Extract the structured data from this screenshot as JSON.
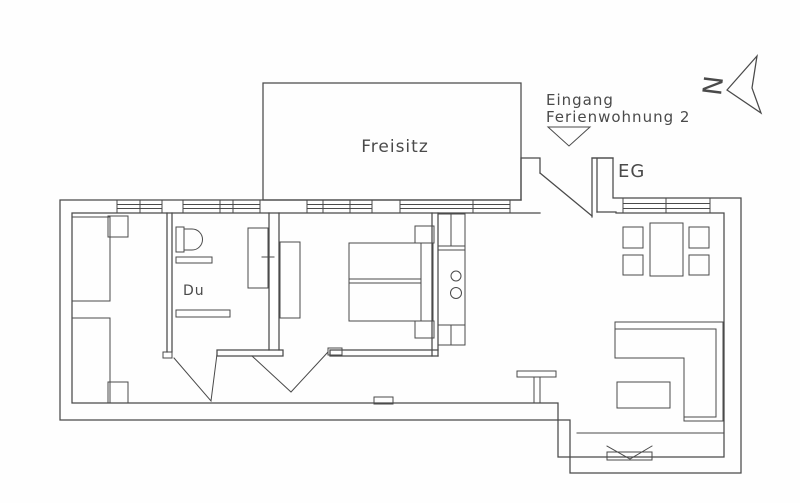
{
  "page": {
    "background": "#fefefe",
    "ink_color": "#4a4a4a",
    "text_color": "#4a4a4a"
  },
  "labels": {
    "terrace": "Freisitz",
    "entrance_line1": "Eingang",
    "entrance_line2": "Ferienwohnung 2",
    "floor_level": "EG",
    "shower": "Du",
    "north_letter": "N"
  },
  "icons": {
    "north_arrow": "compass-needle-triangle",
    "entrance_arrow": "downward-triangle-marker",
    "hearth_marker": "v-notch-sill"
  },
  "diagram": {
    "type": "floor-plan",
    "description": "Scanned ground-floor plan (EG) of holiday apartment 2 with terrace (Freisitz), twin-bed room, shower room (Du), double bedroom, kitchenette strip and living/dining area with corner sofa"
  }
}
